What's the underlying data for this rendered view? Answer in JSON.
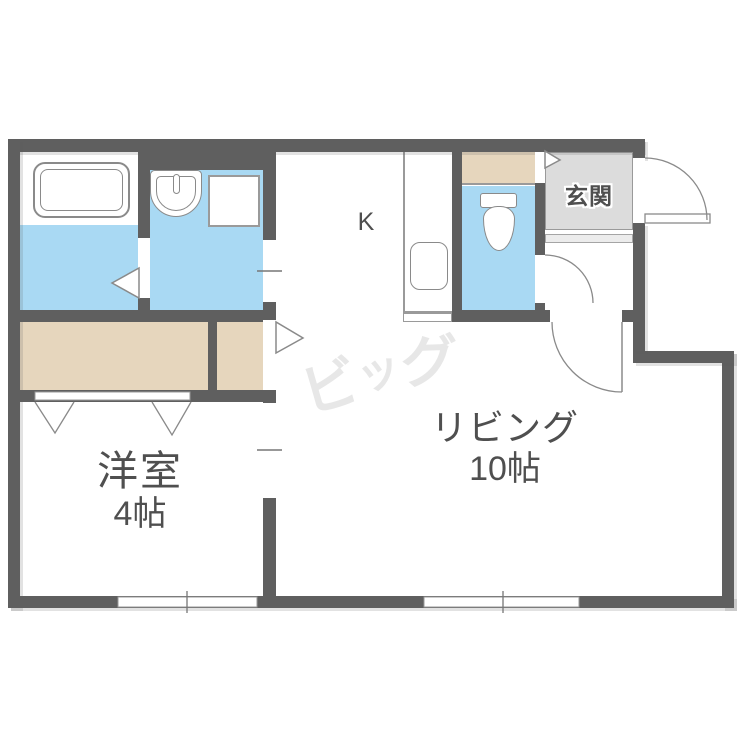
{
  "labels": {
    "kitchen": "K",
    "entrance": "玄関",
    "living_name": "リビング",
    "living_size": "10帖",
    "western_name": "洋室",
    "western_size": "4帖"
  },
  "watermark": {
    "text_c1": "ビ",
    "text_c2": "ッ",
    "text_c3": "グ",
    "text": "ビッグ"
  },
  "fixtures": [
    "bathtub",
    "washbasin",
    "washing-machine-space",
    "toilet",
    "kitchen-counter",
    "kitchen-sink",
    "entrance-floor",
    "entrance-step",
    "closet",
    "storage-shelf"
  ],
  "colors": {
    "wall": "#5f5f5f",
    "wet-area-floor": "#a9d9f3",
    "closet-floor": "#e6d6bd",
    "entrance-floor": "#dcdcdc",
    "label-text": "#4f4f4f",
    "line": "#8a8a8a",
    "watermark": "#e7e7e7"
  }
}
